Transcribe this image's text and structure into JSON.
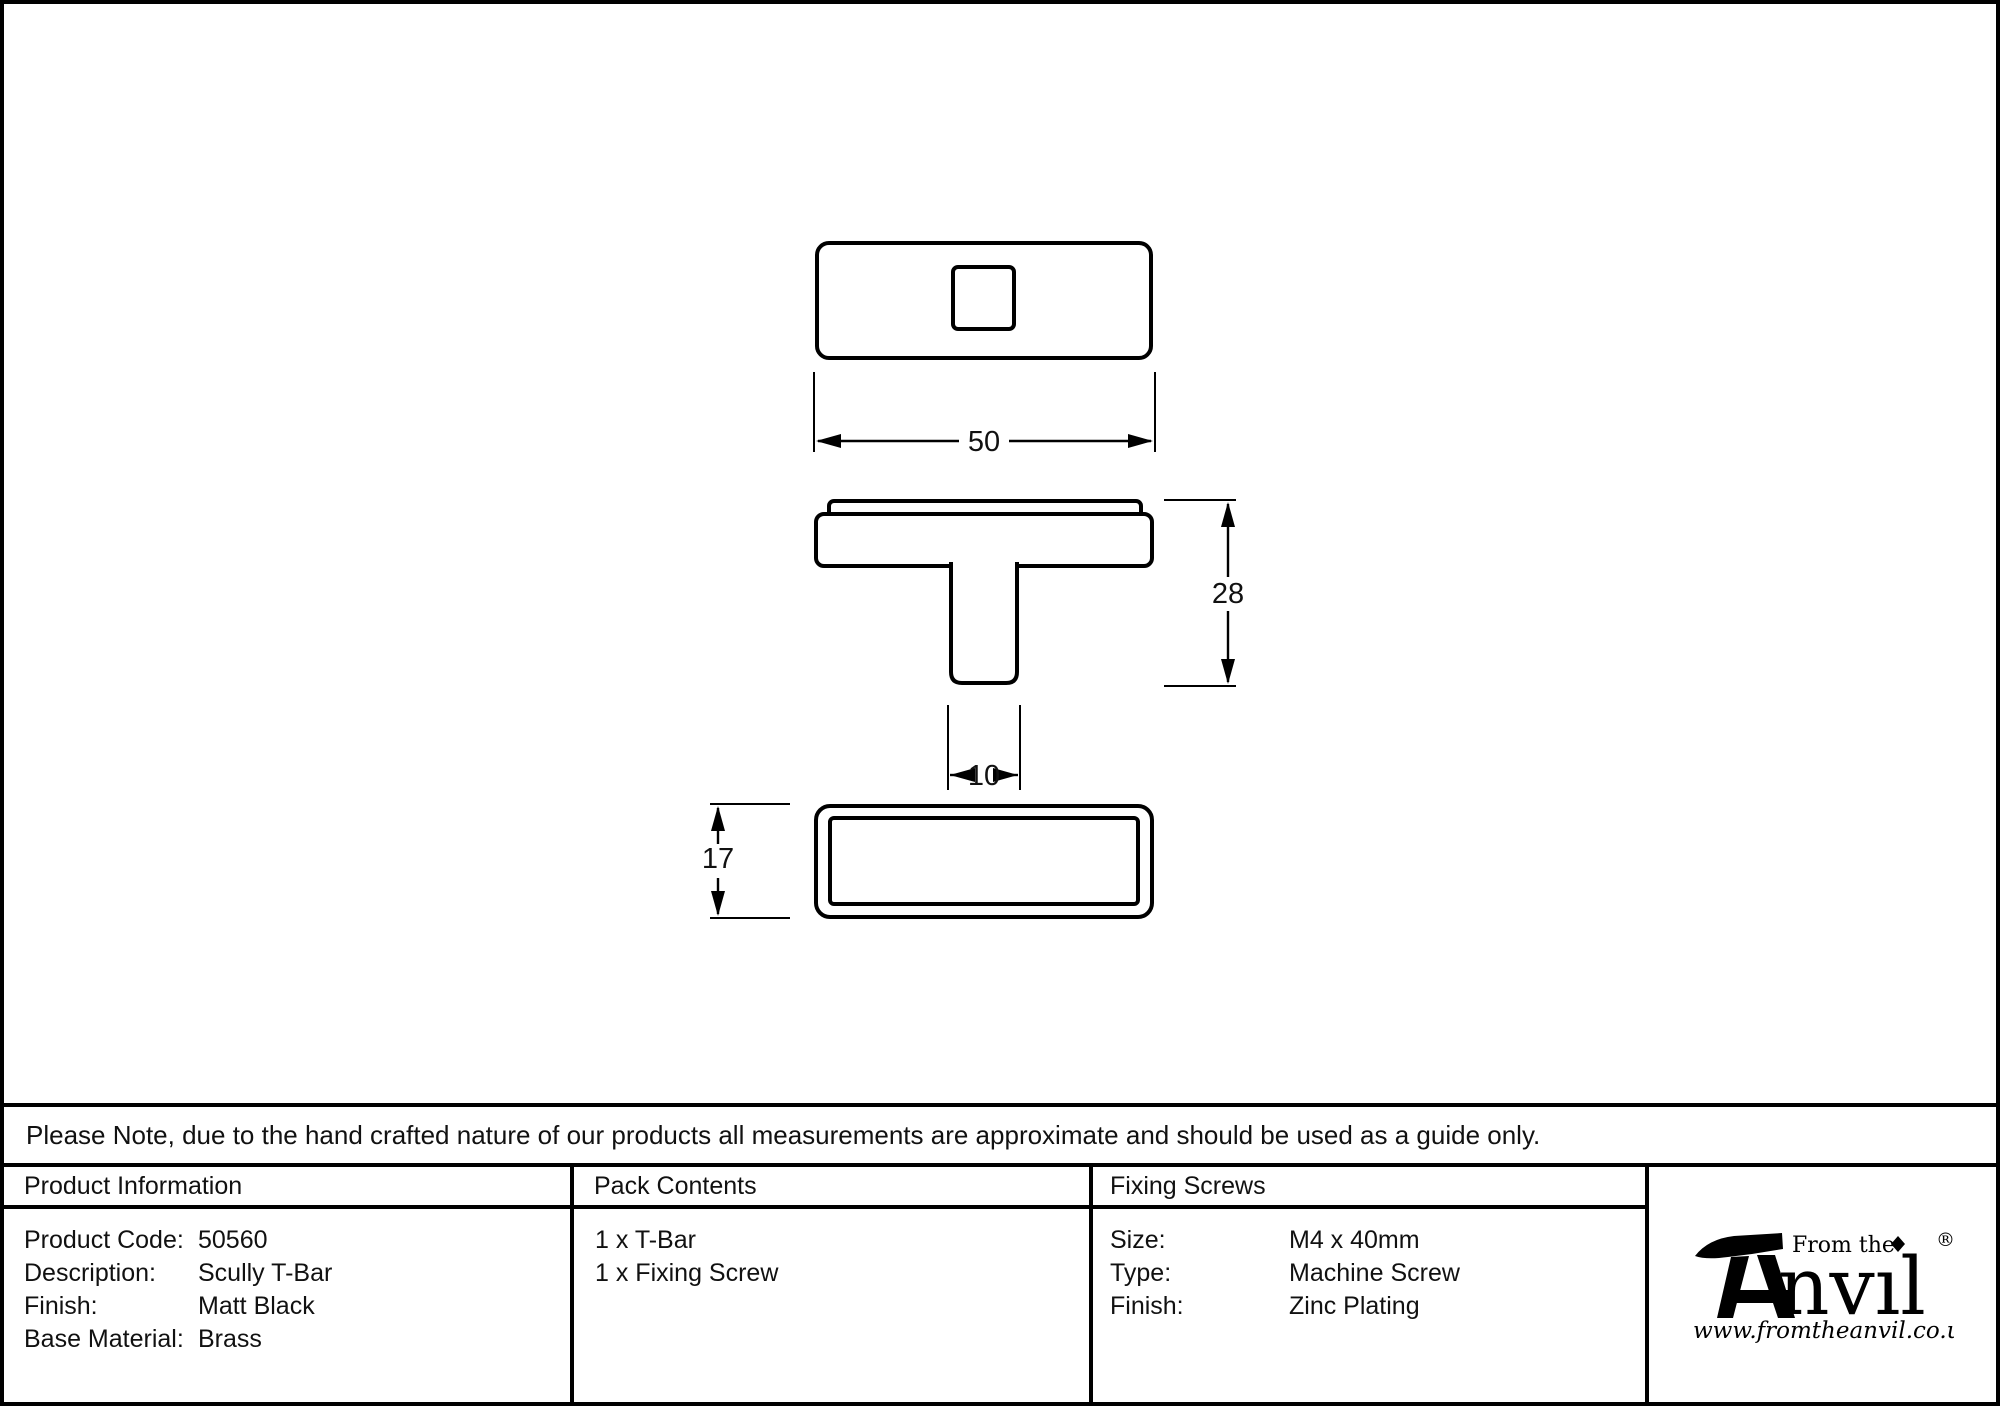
{
  "dimensions": {
    "width": "50",
    "height": "28",
    "stem_width": "10",
    "depth": "17"
  },
  "note": "Please Note, due to the hand crafted nature of our products all measurements are approximate and should be used as a guide only.",
  "table": {
    "product_information": {
      "title": "Product Information",
      "rows": [
        {
          "label": "Product Code:",
          "value": "50560"
        },
        {
          "label": "Description:",
          "value": "Scully T-Bar"
        },
        {
          "label": "Finish:",
          "value": "Matt Black"
        },
        {
          "label": "Base Material:",
          "value": "Brass"
        }
      ]
    },
    "pack_contents": {
      "title": "Pack Contents",
      "items": [
        "1 x T-Bar",
        "1 x Fixing Screw"
      ]
    },
    "fixing_screws": {
      "title": "Fixing Screws",
      "rows": [
        {
          "label": "Size:",
          "value": "M4 x 40mm"
        },
        {
          "label": "Type:",
          "value": "Machine Screw"
        },
        {
          "label": "Finish:",
          "value": "Zinc Plating"
        }
      ]
    }
  },
  "logo": {
    "tagline": "From the",
    "brand_suffix": "nvıl",
    "registered": "®",
    "website": "www.fromtheanvil.co.uk"
  },
  "colors": {
    "line": "#000000",
    "background": "#ffffff"
  }
}
